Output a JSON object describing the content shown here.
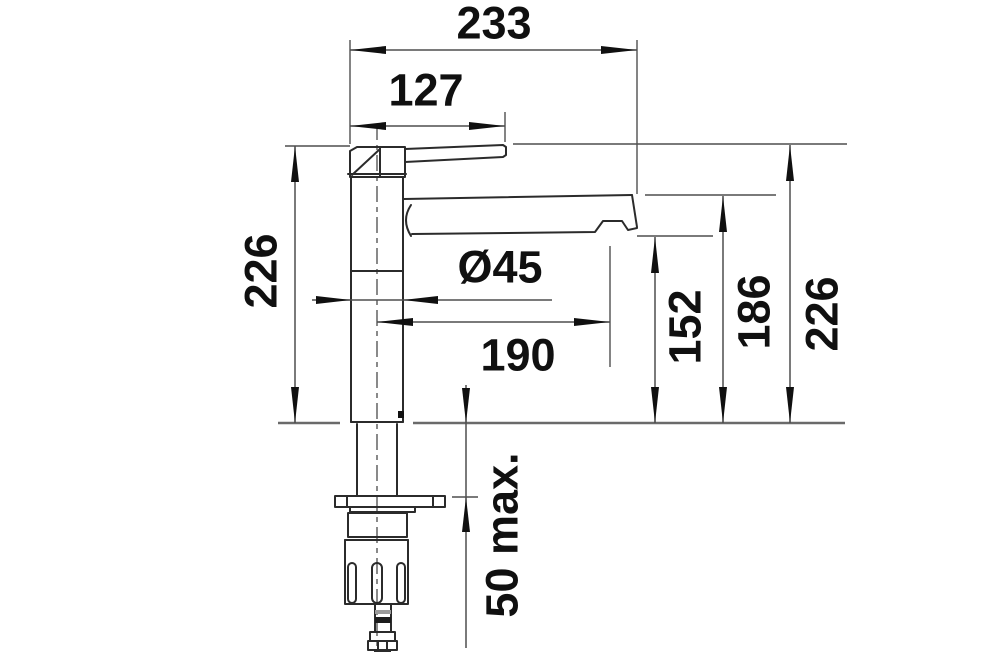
{
  "diagram": {
    "type": "technical-dimension-drawing",
    "subject": "single-lever kitchen mixer tap, side elevation with mounting hardware",
    "units": "mm",
    "colors": {
      "background": "#ffffff",
      "object_line": "#2b2b2b",
      "dimension_line": "#4f4f4f",
      "deck_line": "#6a6a6a",
      "text": "#101010"
    },
    "dims": {
      "overall_projection": "233",
      "handle_length": "127",
      "height_left": "226",
      "diameter": "Ø45",
      "reach": "190",
      "spout_underside_height": "152",
      "spout_top_height": "186",
      "overall_height": "226",
      "deck_max_thickness": "50 max."
    },
    "dimension_list": [
      {
        "value": "233",
        "orientation": "horizontal",
        "measures": "overall horizontal projection, body axis to dimension limit"
      },
      {
        "value": "127",
        "orientation": "horizontal",
        "measures": "lever handle length from body axis"
      },
      {
        "value": "226",
        "orientation": "vertical",
        "measures": "left side: height from deck to top of handle"
      },
      {
        "value": "Ø45",
        "orientation": "horizontal",
        "measures": "body column diameter"
      },
      {
        "value": "190",
        "orientation": "horizontal",
        "measures": "spout reach, body axis to outlet axis"
      },
      {
        "value": "152",
        "orientation": "vertical",
        "measures": "deck to spout underside / outlet"
      },
      {
        "value": "186",
        "orientation": "vertical",
        "measures": "deck to top of spout"
      },
      {
        "value": "226",
        "orientation": "vertical",
        "measures": "right side: deck to top of handle"
      },
      {
        "value": "50 max.",
        "orientation": "vertical",
        "measures": "maximum countertop thickness"
      }
    ]
  }
}
